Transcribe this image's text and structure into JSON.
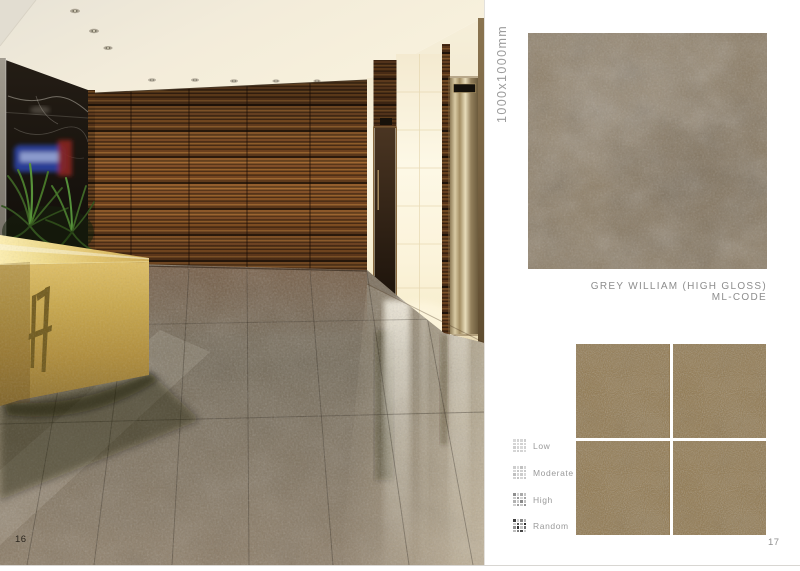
{
  "page": {
    "left_number": "16",
    "right_number": "17"
  },
  "product": {
    "size_label": "1000x1000mm",
    "name": "GREY WILLIAM (HIGH GLOSS)",
    "code": "ML-CODE"
  },
  "legend": {
    "items": [
      {
        "label": "Low",
        "cells": [
          "#d9d9d9",
          "#d3d3d3",
          "#d7d7d7",
          "#cfcfcf",
          "#d5d5d5",
          "#dbdbdb",
          "#d1d1d1",
          "#d7d7d7",
          "#cfcfcf",
          "#d5d5d5",
          "#dadada",
          "#d2d2d2",
          "#d6d6d6",
          "#d0d0d0",
          "#d4d4d4",
          "#d9d9d9"
        ]
      },
      {
        "label": "Moderate",
        "cells": [
          "#cdcdcd",
          "#dadada",
          "#c2c2c2",
          "#d5d5d5",
          "#d8d8d8",
          "#c6c6c6",
          "#d2d2d2",
          "#cacaca",
          "#c0c0c0",
          "#d6d6d6",
          "#cccccc",
          "#d9d9d9",
          "#d3d3d3",
          "#c4c4c4",
          "#d7d7d7",
          "#c8c8c8"
        ]
      },
      {
        "label": "High",
        "cells": [
          "#8f8f8f",
          "#d2d2d2",
          "#aaaaaa",
          "#c6c6c6",
          "#c9c9c9",
          "#9b9b9b",
          "#d5d5d5",
          "#a5a5a5",
          "#b2b2b2",
          "#cdcdcd",
          "#8a8a8a",
          "#c2c2c2",
          "#d0d0d0",
          "#a0a0a0",
          "#c8c8c8",
          "#939393"
        ]
      },
      {
        "label": "Random",
        "cells": [
          "#3f3f3f",
          "#cfcfcf",
          "#848484",
          "#b5b5b5",
          "#c9c9c9",
          "#565656",
          "#a8a8a8",
          "#2f2f2f",
          "#909090",
          "#333333",
          "#c4c4c4",
          "#6f6f6f",
          "#bcbcbc",
          "#7a7a7a",
          "#474747",
          "#cccccc"
        ]
      }
    ]
  },
  "colors": {
    "main_tile_base": "#877b6c",
    "layout_tile_base": "#87785f",
    "desk_gold": "#c9a84c",
    "wood_dark": "#2a1a0c",
    "wood_light": "#a06a34",
    "floor_base": "#7b7060"
  }
}
